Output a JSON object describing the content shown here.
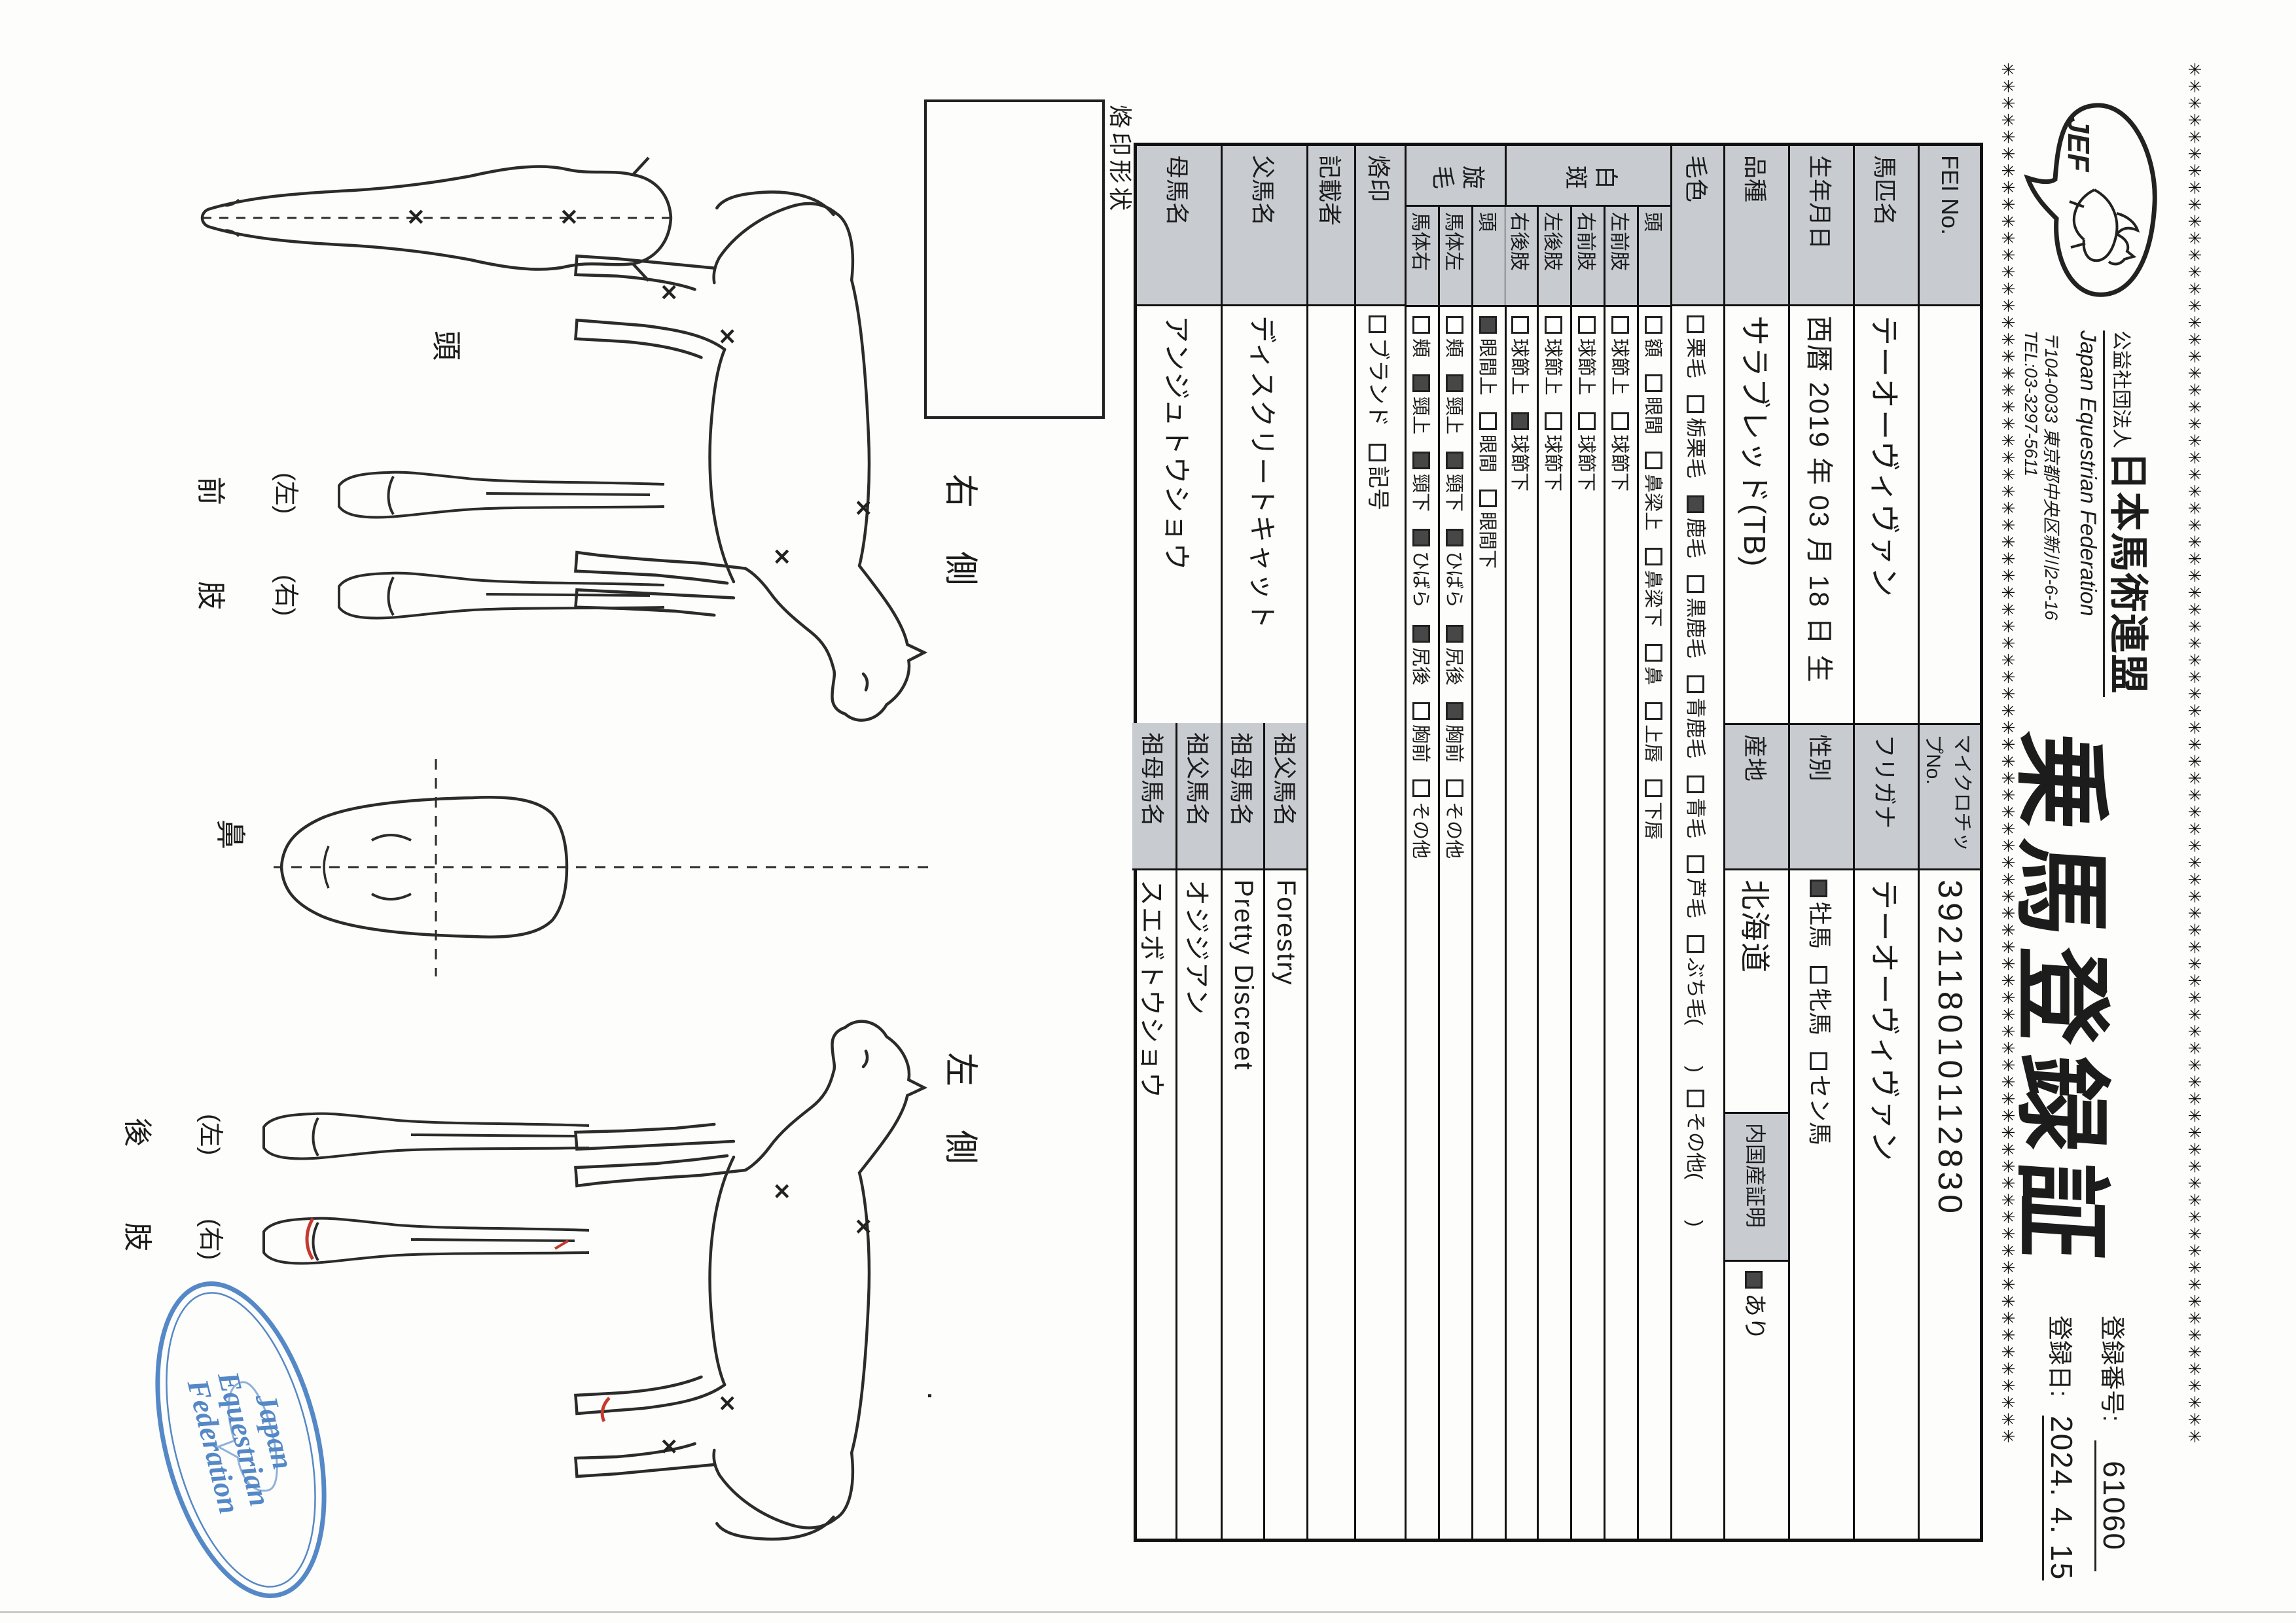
{
  "header": {
    "org_small": "公益社団法人",
    "org_name": "日本馬術連盟",
    "org_en": "Japan Equestrian Federation",
    "address": "〒104-0033 東京都中央区新川2-6-16",
    "tel": "TEL:03-3297-5611",
    "logo_text": "JEF",
    "title": "乗馬登録証",
    "reg_no_label": "登録番号:",
    "reg_no": "61060",
    "reg_date_label": "登録日:",
    "reg_date": "2024. 4. 15"
  },
  "table": {
    "fei_label": "FEI No.",
    "fei_value": "",
    "microchip_label": "マイクロチップNo.",
    "microchip": "392118010112830",
    "name_label": "馬匹名",
    "name": "テーオーヴィヴァン",
    "furigana_label": "フリガナ",
    "furigana": "テーオーヴィヴァン",
    "birth_label": "生年月日",
    "birth": "西暦 2019 年 03 月 18 日 生",
    "sex_label": "性別",
    "sex_options": [
      {
        "label": "牡馬",
        "checked": true
      },
      {
        "label": "牝馬",
        "checked": false
      },
      {
        "label": "セン馬",
        "checked": false
      }
    ],
    "breed_label": "品種",
    "breed": "サラブレッド(TB)",
    "origin_label": "産地",
    "origin": "北海道",
    "domestic_label": "内国産証明",
    "domestic_options": [
      {
        "label": "あり",
        "checked": true
      }
    ],
    "coat_label": "毛色",
    "coat_options": [
      {
        "label": "栗毛",
        "checked": false
      },
      {
        "label": "栃栗毛",
        "checked": false
      },
      {
        "label": "鹿毛",
        "checked": true
      },
      {
        "label": "黒鹿毛",
        "checked": false
      },
      {
        "label": "青鹿毛",
        "checked": false
      },
      {
        "label": "青毛",
        "checked": false
      },
      {
        "label": "芦毛",
        "checked": false
      },
      {
        "label": "ぶち毛(　　)",
        "checked": false
      },
      {
        "label": "その他(　　)",
        "checked": false
      }
    ],
    "hakuhan_label": "白斑",
    "hakuhan_rows": [
      {
        "part": "頭",
        "options": [
          {
            "label": "額",
            "checked": false
          },
          {
            "label": "眼間",
            "checked": false
          },
          {
            "label": "鼻梁上",
            "checked": false
          },
          {
            "label": "鼻梁下",
            "checked": false
          },
          {
            "label": "鼻",
            "checked": false
          },
          {
            "label": "上唇",
            "checked": false
          },
          {
            "label": "下唇",
            "checked": false
          }
        ]
      },
      {
        "part": "左前肢",
        "options": [
          {
            "label": "球節上",
            "checked": false
          },
          {
            "label": "球節下",
            "checked": false
          }
        ]
      },
      {
        "part": "右前肢",
        "options": [
          {
            "label": "球節上",
            "checked": false
          },
          {
            "label": "球節下",
            "checked": false
          }
        ]
      },
      {
        "part": "左後肢",
        "options": [
          {
            "label": "球節上",
            "checked": false
          },
          {
            "label": "球節下",
            "checked": false
          }
        ]
      },
      {
        "part": "右後肢",
        "options": [
          {
            "label": "球節上",
            "checked": false
          },
          {
            "label": "球節下",
            "checked": true
          }
        ]
      }
    ],
    "senmou_label": "旋毛",
    "senmou_rows": [
      {
        "part": "頭",
        "options": [
          {
            "label": "眼間上",
            "checked": true
          },
          {
            "label": "眼間",
            "checked": false
          },
          {
            "label": "眼間下",
            "checked": false
          }
        ]
      },
      {
        "part": "馬体左",
        "options": [
          {
            "label": "頬",
            "checked": false
          },
          {
            "label": "頸上",
            "checked": true
          },
          {
            "label": "頸下",
            "checked": true
          },
          {
            "label": "ひばら",
            "checked": true
          },
          {
            "label": "尻後",
            "checked": true
          },
          {
            "label": "胸前",
            "checked": true
          },
          {
            "label": "その他",
            "checked": false
          }
        ]
      },
      {
        "part": "馬体右",
        "options": [
          {
            "label": "頬",
            "checked": false
          },
          {
            "label": "頸上",
            "checked": true
          },
          {
            "label": "頸下",
            "checked": true
          },
          {
            "label": "ひばら",
            "checked": true
          },
          {
            "label": "尻後",
            "checked": true
          },
          {
            "label": "胸前",
            "checked": false
          },
          {
            "label": "その他",
            "checked": false
          }
        ]
      }
    ],
    "brand_label": "烙印",
    "brand_options": [
      {
        "label": "ブランド",
        "checked": false
      },
      {
        "label": "記号",
        "checked": false
      }
    ],
    "recorder_label": "記載者",
    "recorder": "",
    "sire_label": "父馬名",
    "sire": "ディスクリートキャット",
    "sire_gf_label": "祖父馬名",
    "sire_gf": "Forestry",
    "sire_gm_label": "祖母馬名",
    "sire_gm": "Pretty Discreet",
    "dam_label": "母馬名",
    "dam": "アンジュトウショウ",
    "dam_gf_label": "祖父馬名",
    "dam_gf": "オジジアン",
    "dam_gm_label": "祖母馬名",
    "dam_gm": "スエボトウショウ"
  },
  "diagram": {
    "brand_box_label": "烙印形状",
    "right_side_label": "右 側",
    "left_side_label": "左 側",
    "head_label": "頭",
    "nose_label": "鼻",
    "front_label_a": "前",
    "front_label_b": "肢",
    "hind_label_a": "後",
    "hind_label_b": "肢",
    "left_paren": "(左)",
    "right_paren": "(右)"
  },
  "stamp": {
    "line1": "Japan",
    "line2": "Equestrian",
    "line3": "Federation",
    "color": "#3e78c0"
  },
  "decorations": {
    "asterisk_char": "✳",
    "asterisk_count": 82
  }
}
